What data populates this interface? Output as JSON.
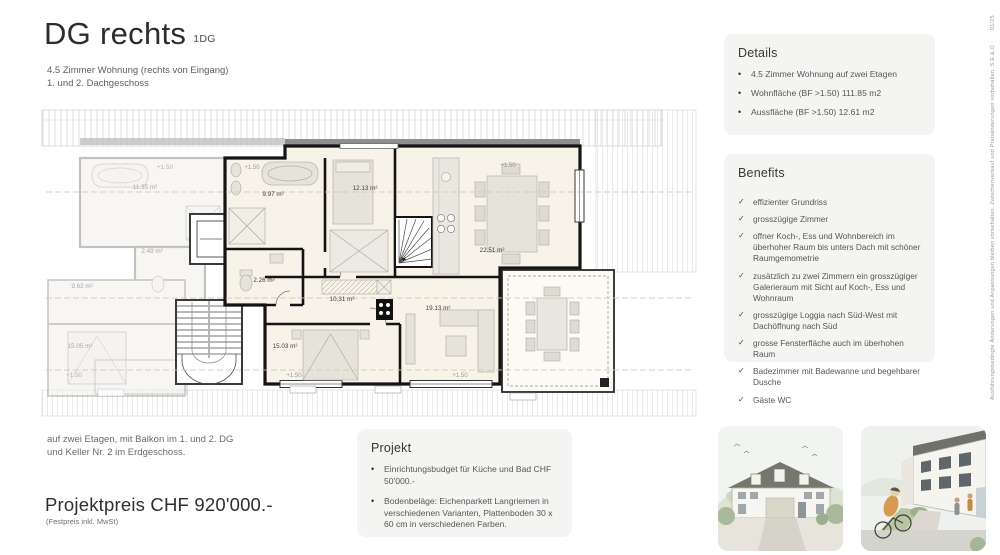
{
  "page": {
    "code": "01/25",
    "disclaimer": "Ausführungsbedingte Änderungen und Anpassungen bleiben vorbehalten. Zwischenverkauf und Preisänderungen vorbehalten. S.E.&.O"
  },
  "header": {
    "title": "DG rechts",
    "title_suffix": "1DG",
    "subtitle_line1": "4.5 Zimmer Wohnung (rechts von Eingang)",
    "subtitle_line2": "1. und 2. Dachgeschoss"
  },
  "details": {
    "title": "Details",
    "bullet_icon": "•",
    "items": [
      "4.5 Zimmer Wohnung auf zwei Etagen",
      "Wohnfläche (BF >1.50) 111.85 m2",
      "Aussfläche (BF >1.50) 12.61 m2"
    ]
  },
  "benefits": {
    "title": "Benefits",
    "check_icon": "✓",
    "items": [
      "effizienter Grundriss",
      "grosszügige Zimmer",
      "offner Koch-, Ess und Wohnbereich im überhoher Raum bis unters Dach mit schöner Raumgemometrie",
      "zusätzlich zu zwei Zimmern ein grosszügiger Galerieraum mit Sicht auf Koch-, Ess und Wohnraum",
      "grosszügige Loggia nach Süd-West mit Dachöffnung nach Süd",
      "grosse Fensterfläche auch im überhohen Raum",
      "Badezimmer mit Badewanne und begehbarer Dusche",
      "Gäste WC"
    ]
  },
  "projekt": {
    "title": "Projekt",
    "bullet_icon": "•",
    "items": [
      "Einrichtungsbudget für Küche und Bad CHF 50'000.-",
      "Bodenbeläge: Eichenparkett Langriemen in verschiedenen Varianten, Plattenboden 30 x 60 cm in verschiedenen Farben."
    ]
  },
  "footer": {
    "note_line1": "auf zwei Etagen, mit Balkon im 1. und 2. DG",
    "note_line2": "und Keller Nr. 2 im Erdgeschoss.",
    "price": "Projektpreis CHF 920'000.-",
    "price_note": "(Festpreis inkl. MwSt)"
  },
  "plan": {
    "level_label": "+1.50",
    "unit_rooms": {
      "bath": "9.97 m²",
      "bedroom_top": "12.13 m²",
      "wc": "2.26 m²",
      "kitchen_dining": "22.51 m²",
      "corridor": "10.31 m²",
      "bedroom_bottom": "15.03 m²",
      "living": "19.13 m²"
    },
    "neighbor_rooms": {
      "room1": "11.35 m²",
      "room2": "2.49 m²",
      "room3": "9.62 m²",
      "room4": "15.05 m²"
    }
  },
  "colors": {
    "panel_bg": "#f4f4f3",
    "plan_floor": "#f8f3e9",
    "wall": "#141414",
    "text_dark": "#2d2d2d",
    "text_gray": "#6a6a6a"
  }
}
